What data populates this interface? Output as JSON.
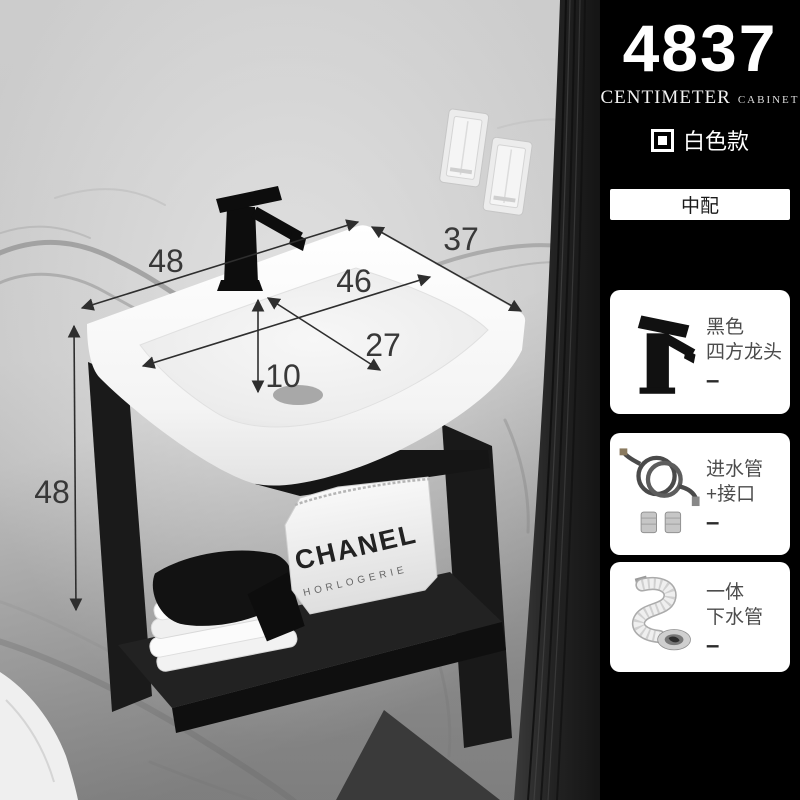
{
  "scene": {
    "dimensions": {
      "top_width": "48",
      "side_depth": "37",
      "basin_inner_width": "46",
      "basin_inner_depth": "27",
      "basin_inner_height": "10",
      "frame_height": "48"
    },
    "bag": {
      "brand": "CHANEL",
      "subtitle": "HORLOGERIE"
    }
  },
  "panel": {
    "model_number": "4837",
    "unit_label": "CENTIMETER",
    "unit_sublabel": "CABINET",
    "variant_label": "白色款",
    "config_label": "中配",
    "accessories": [
      {
        "name": "black-square-faucet",
        "line1": "黑色",
        "line2": "四方龙头",
        "dash": "–"
      },
      {
        "name": "inlet-hose-and-connectors",
        "line1": "进水管",
        "line2": "+接口",
        "dash": "–"
      },
      {
        "name": "one-piece-drain-pipe",
        "line1": "一体",
        "line2": "下水管",
        "dash": "–"
      }
    ],
    "colors": {
      "panel_bg": "#000000",
      "card_bg": "#ffffff",
      "dimension_text": "#383838"
    }
  }
}
